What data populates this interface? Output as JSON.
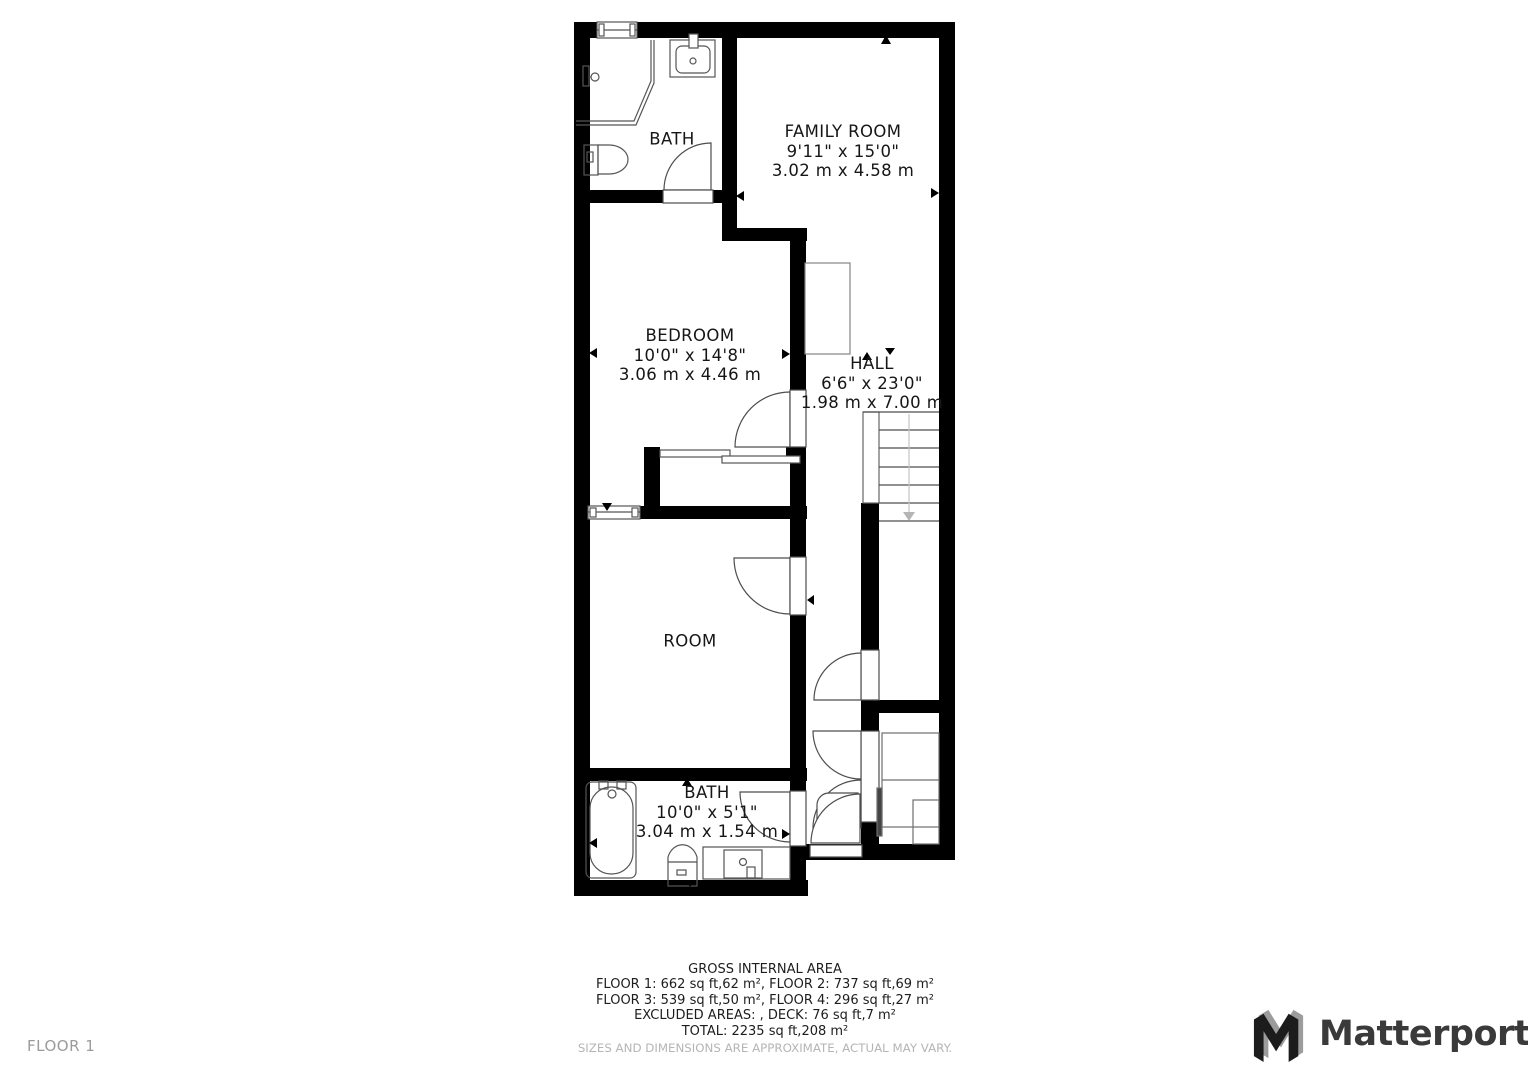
{
  "page": {
    "floor_label": "FLOOR 1"
  },
  "brand": {
    "name": "Matterport"
  },
  "rooms": {
    "bath_upper": {
      "name": "BATH"
    },
    "family_room": {
      "name": "FAMILY ROOM",
      "dims_ft": "9'11\" x 15'0\"",
      "dims_m": "3.02 m x 4.58 m"
    },
    "bedroom": {
      "name": "BEDROOM",
      "dims_ft": "10'0\" x 14'8\"",
      "dims_m": "3.06 m x 4.46 m"
    },
    "hall": {
      "name": "HALL",
      "dims_ft": "6'6\" x 23'0\"",
      "dims_m": "1.98 m x 7.00 m"
    },
    "room": {
      "name": "ROOM"
    },
    "bath_lower": {
      "name": "BATH",
      "dims_ft": "10'0\" x 5'1\"",
      "dims_m": "3.04 m x 1.54 m"
    }
  },
  "footer": {
    "title": "GROSS INTERNAL AREA",
    "line1": "FLOOR 1: 662 sq ft,62 m², FLOOR 2: 737 sq ft,69 m²",
    "line2": "FLOOR 3: 539 sq ft,50 m², FLOOR 4: 296 sq ft,27 m²",
    "line3": "EXCLUDED AREAS: , DECK: 76 sq ft,7 m²",
    "line4": "TOTAL: 2235 sq ft,208 m²",
    "disclaimer": "SIZES AND DIMENSIONS ARE APPROXIMATE, ACTUAL MAY VARY."
  },
  "colors": {
    "wall": "#000000",
    "fixture_line": "#555555",
    "furniture_line": "#848484",
    "light_line": "#b5b5b5",
    "text": "#161616",
    "muted_text": "#b5b5b5",
    "floor_label_text": "#9b9b9b",
    "brand_dark": "#3a3a3a",
    "brand_gray": "#9c9c9c"
  }
}
